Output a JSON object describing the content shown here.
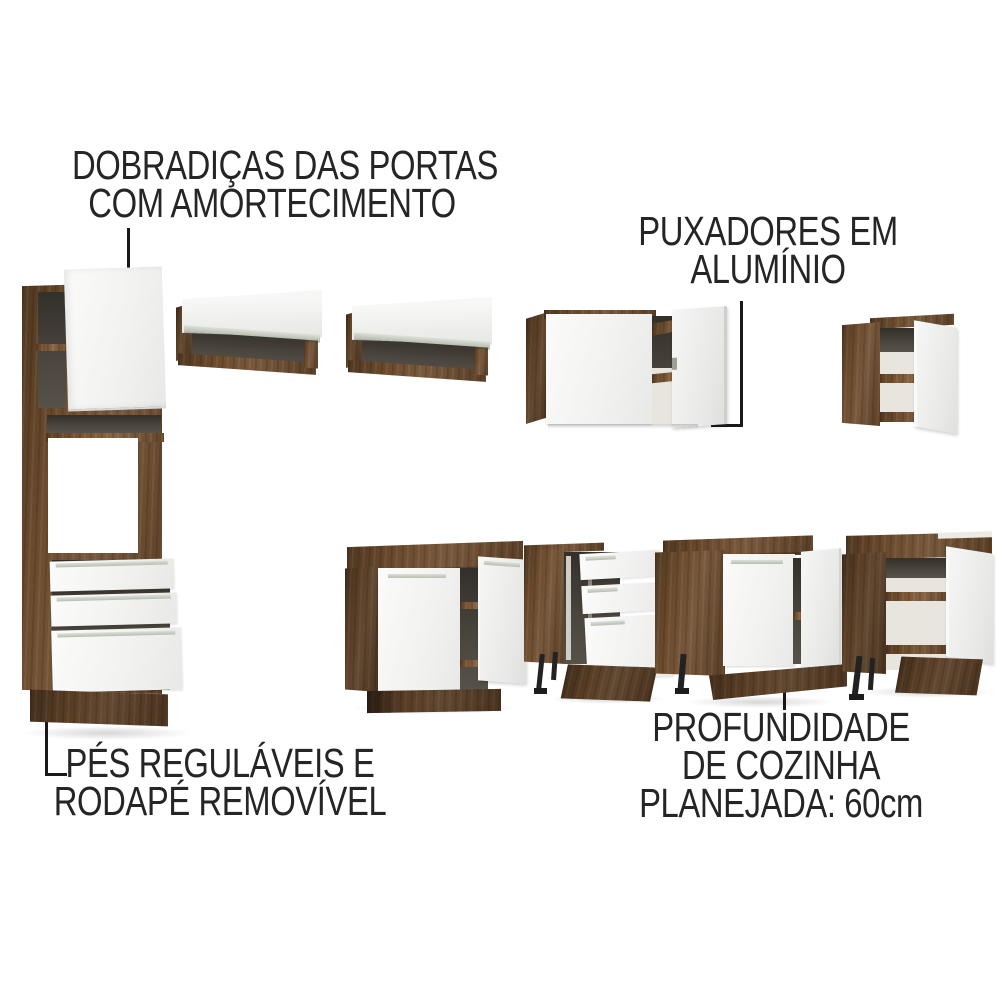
{
  "annotations": {
    "hinges": {
      "line1": "DOBRADIÇAS DAS PORTAS",
      "line2": "COM AMORTECIMENTO"
    },
    "handles": {
      "line1": "PUXADORES EM",
      "line2": "ALUMÍNIO"
    },
    "feet": {
      "line1": "PÉS REGULÁVEIS E",
      "line2": "RODAPÉ REMOVÍVEL"
    },
    "depth": {
      "line1": "PROFUNDIDADE",
      "line2": "DE COZINHA",
      "line3": "PLANEJADA: 60cm"
    }
  },
  "colors": {
    "background": "#ffffff",
    "text": "#252525",
    "leader_line": "#191919",
    "wood": "#6d4c2e",
    "wood_dark": "#54381f",
    "door_white": "#f4f4f3",
    "interior_dark": "#45413a",
    "aluminum_handle": "#c7cdc2",
    "feet_black": "#222222"
  }
}
